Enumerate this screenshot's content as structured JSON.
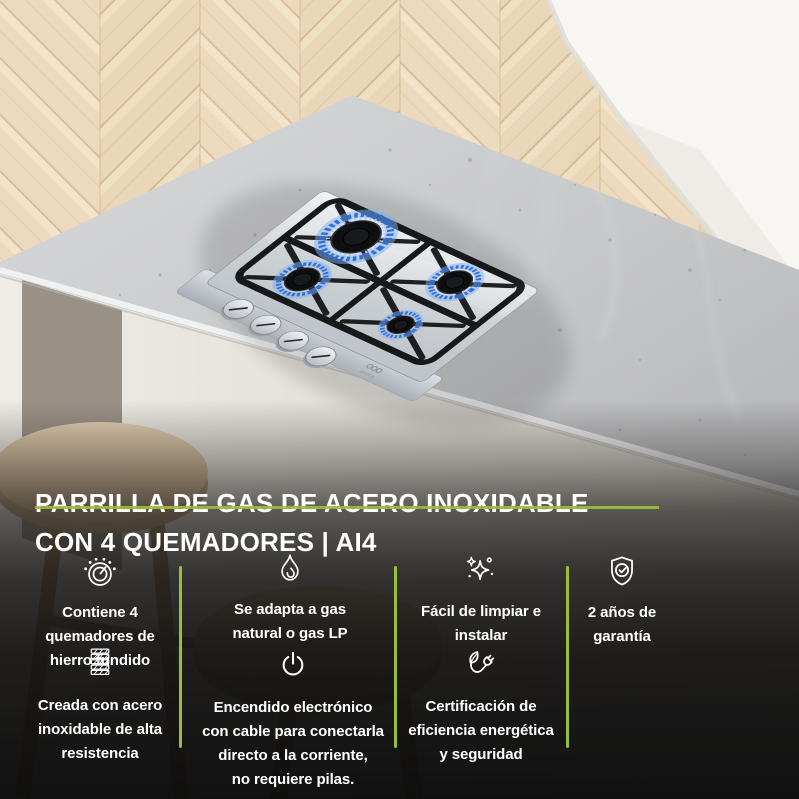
{
  "title": {
    "line1": "PARRILLA DE GAS DE ACERO INOXIDABLE",
    "line2": "CON 4 QUEMADORES | AI4"
  },
  "features": [
    {
      "icon": "burner-icon",
      "label": "Contiene 4\nquemadores de\nhierro fundido"
    },
    {
      "icon": "flame-icon",
      "label": "Se adapta a gas\nnatural o gas LP"
    },
    {
      "icon": "sparkles-icon",
      "label": "Fácil de limpiar e\ninstalar"
    },
    {
      "icon": "shield-check-icon",
      "label": "2 años de\ngarantía"
    },
    {
      "icon": "steel-sheets-icon",
      "label": "Creada con acero\ninoxidable de alta\nresistencia"
    },
    {
      "icon": "power-icon",
      "label": "Encendido electrónico\ncon cable para conectarla\ndirecto a la corriente,\nno requiere pilas."
    },
    {
      "icon": "eco-plug-icon",
      "label": "Certificación de\neficiencia energética\ny seguridad"
    }
  ],
  "photo": {
    "brand_logo": "avera",
    "burner_count": "4",
    "knob_count": "4"
  },
  "colors": {
    "accent_green": "#9cbd3c",
    "flame_blue": "#2e6fd8",
    "text": "#ffffff",
    "overlay_dark": "#141414"
  }
}
